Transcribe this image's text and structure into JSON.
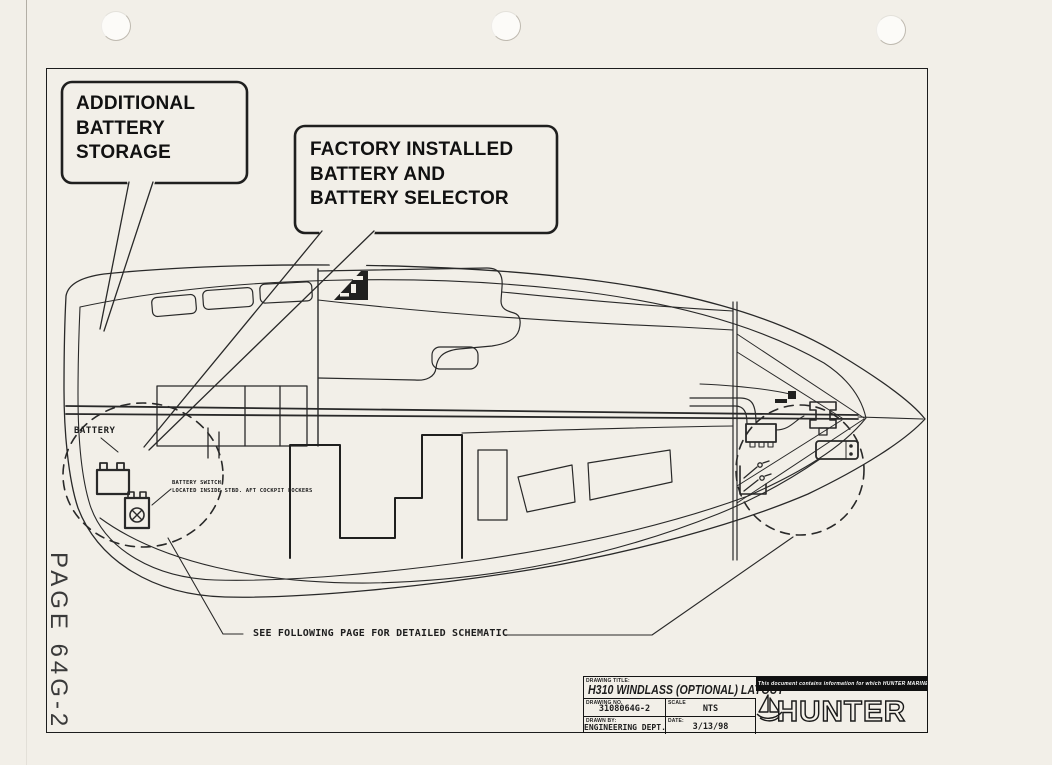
{
  "page": {
    "label": "PAGE 64G-2",
    "paper_color": "#f2efe8",
    "ink_color": "#1d1d1d"
  },
  "callouts": {
    "additional_battery": "ADDITIONAL\nBATTERY\nSTORAGE",
    "factory_installed": "FACTORY INSTALLED\nBATTERY AND\nBATTERY SELECTOR"
  },
  "annotations": {
    "battery": "BATTERY",
    "battery_switch_note": "BATTERY SWITCH\nLOCATED INSIDE STBD. AFT COCKPIT LOCKERS",
    "see_following_page": "SEE FOLLOWING PAGE FOR DETAILED SCHEMATIC"
  },
  "title_block": {
    "drawing_title_label": "DRAWING TITLE:",
    "drawing_title": "H310 WINDLASS (OPTIONAL) LAYOUT",
    "drawing_no_label": "DRAWING NO.",
    "drawing_no": "3108064G-2",
    "scale_label": "SCALE",
    "scale": "NTS",
    "drawn_by_label": "DRAWN BY:",
    "drawn_by": "ENGINEERING DEPT.",
    "date_label": "DATE:",
    "date": "3/13/98",
    "proprietary_notice": "This document contains information for which HUNTER MARINE CORP. has proprietary rights.",
    "brand": "HUNTER",
    "logo_icon": "sailboat-icon"
  }
}
